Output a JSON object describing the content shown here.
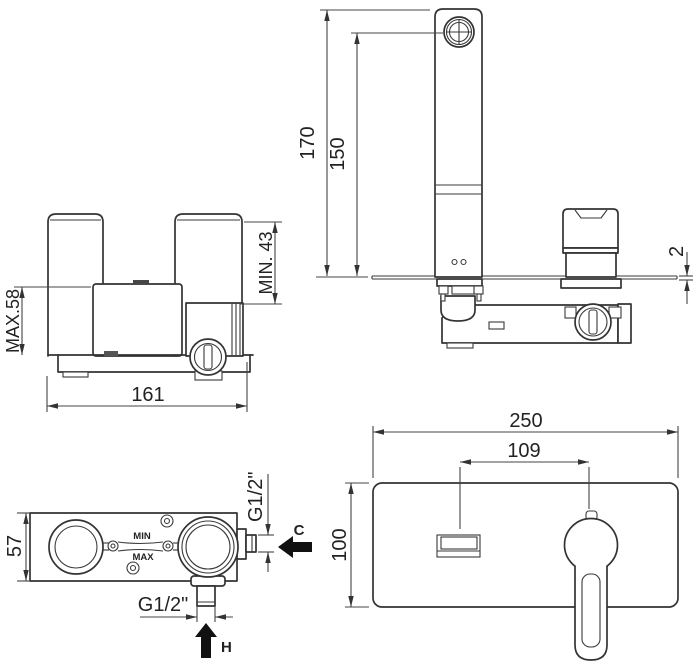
{
  "drawing": {
    "type": "technical-installation-drawing",
    "subject": "wall-mounted single-lever basin mixer",
    "colors": {
      "line": "#333333",
      "dimension": "#444444",
      "text": "#222222",
      "background": "#ffffff",
      "arrow_fill": "#111111"
    },
    "views": {
      "rough_front": {
        "name": "rough-in valve body - front view",
        "max_depth": "MAX.58",
        "min_depth": "MIN. 43",
        "width": "161"
      },
      "side": {
        "name": "mounted mixer - side view",
        "total_height": "170",
        "aerator_height": "150",
        "plate_thickness": "2"
      },
      "rough_top": {
        "name": "rough-in valve body - top view",
        "depth": "57",
        "cold_thread": "G1/2\"",
        "hot_thread": "G1/2\"",
        "min_label": "MIN",
        "max_label": "MAX",
        "cold_label": "C",
        "hot_label": "H"
      },
      "front": {
        "name": "mounted mixer - front view",
        "plate_width": "250",
        "spout_to_handle": "109",
        "plate_height": "100"
      }
    }
  }
}
